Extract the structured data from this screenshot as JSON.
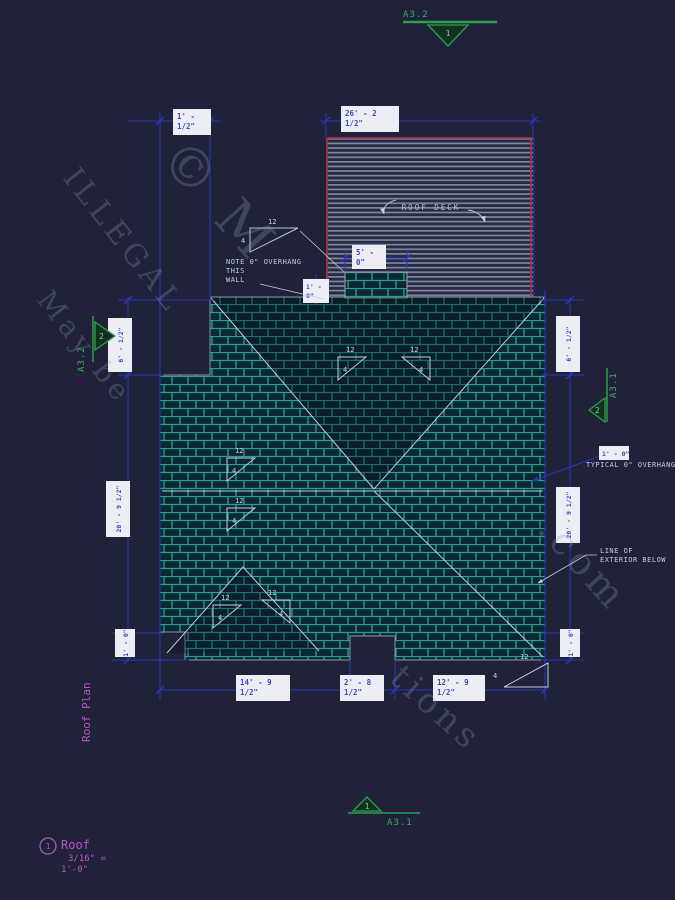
{
  "colors": {
    "background": "#1f2238",
    "dimension_blue": "#2a35c0",
    "shingle_teal": "#27a092",
    "marker_green": "#2e9e4f",
    "title_magenta": "#bb55cc",
    "deck_red": "#99364d",
    "annotation_white": "#c9cede"
  },
  "markers": {
    "top": {
      "label": "A3.2",
      "number": "1"
    },
    "left": {
      "label": "A3.2",
      "number": "2"
    },
    "right": {
      "label": "A3.1",
      "number": "2"
    },
    "bottom": {
      "label": "A3.1",
      "number": "1"
    }
  },
  "labels": {
    "roof_deck": "ROOF DECK",
    "note_line1": "NOTE 0\" OVERHANG",
    "note_line2": "THIS",
    "note_line3": "WALL",
    "typical_overhang": "TYPICAL 0\" OVERHANG",
    "line_of_line1": "LINE OF",
    "line_of_line2": "EXTERIOR BELOW"
  },
  "slope": {
    "run": "12",
    "rise": "4"
  },
  "dimensions": {
    "top_left_l1": "1' -",
    "top_left_l2": "1/2\"",
    "top_l1": "26' - 2",
    "top_l2": "1/2\"",
    "chimney_w_l1": "5' -",
    "chimney_w_l2": "0\"",
    "chimney_s_l1": "1' -",
    "chimney_s_l2": "0\"",
    "left_top": "6' - 1/2\"",
    "left_mid": "20' - 9 1/2\"",
    "left_bot": "1' - 0\"",
    "right_top": "6' - 1/2\"",
    "right_mid": "20' - 9 1/2\"",
    "right_bot": "1' - 0\"",
    "overhang": "1' - 0\"",
    "bottom_1_l1": "14' - 9",
    "bottom_1_l2": "1/2\"",
    "bottom_2_l1": "2' - 8",
    "bottom_2_l2": "1/2\"",
    "bottom_3_l1": "12' - 9",
    "bottom_3_l2": "1/2\""
  },
  "title_block": {
    "plan_title": "Roof Plan",
    "detail_number": "1",
    "detail_name": "Roof",
    "scale_line1": "3/16\" =",
    "scale_line2": "1'-0\""
  },
  "watermarks": {
    "w1": "ILLEGAL",
    "w2": "May be",
    "w3": "© M",
    "w4": ".com",
    "w5": "tions"
  }
}
